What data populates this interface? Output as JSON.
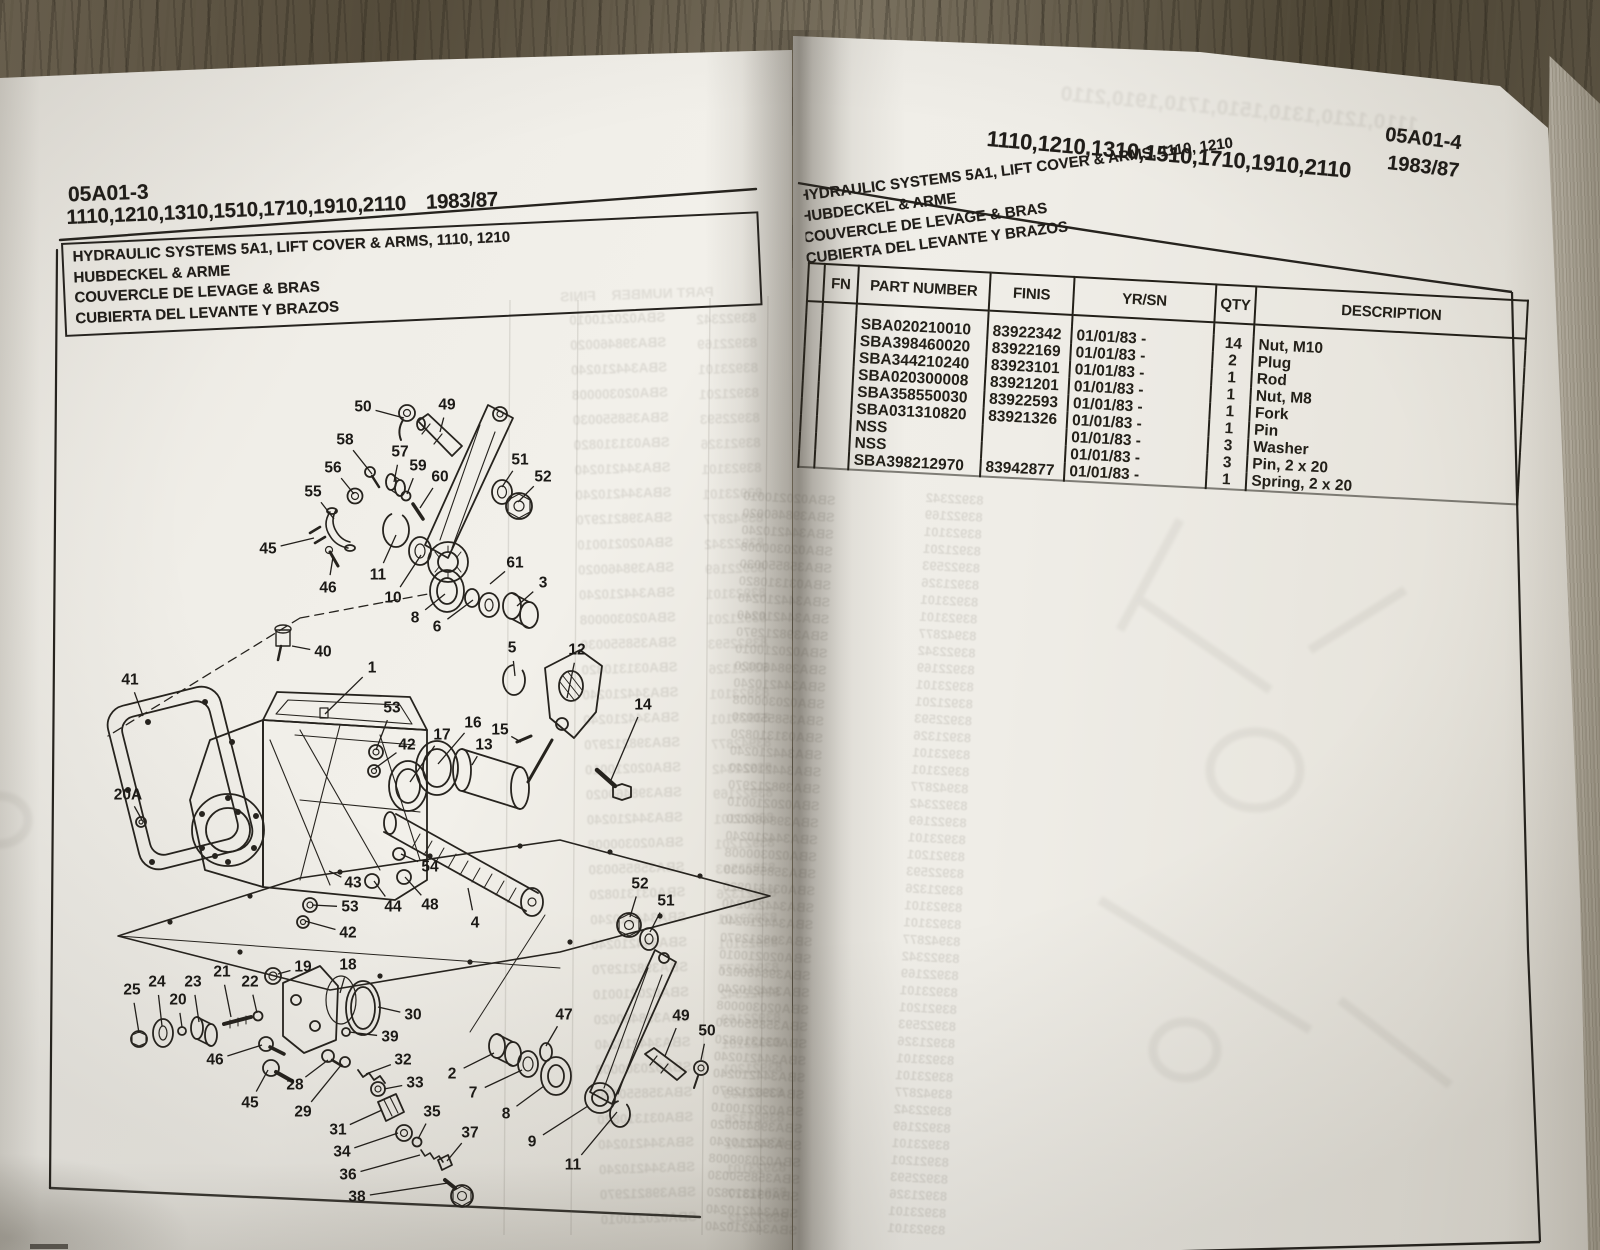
{
  "left_page": {
    "section_code": "05A01-3",
    "models": "1110,1210,1310,1510,1710,1910,2110",
    "years": "1983/87",
    "title_lines": [
      "HYDRAULIC SYSTEMS 5A1, LIFT COVER & ARMS, 1110, 1210",
      "HUBDECKEL & ARME",
      "COUVERCLE DE LEVAGE & BRAS",
      "CUBIERTA DEL LEVANTE Y BRAZOS"
    ],
    "diagram": {
      "callouts": [
        {
          "n": "50",
          "x": 363,
          "y": 407,
          "tx": 404,
          "ty": 418
        },
        {
          "n": "49",
          "x": 447,
          "y": 405,
          "tx": 440,
          "ty": 432
        },
        {
          "n": "58",
          "x": 345,
          "y": 440,
          "tx": 372,
          "ty": 474
        },
        {
          "n": "57",
          "x": 400,
          "y": 452,
          "tx": 394,
          "ty": 482
        },
        {
          "n": "59",
          "x": 418,
          "y": 466,
          "tx": 407,
          "ty": 494
        },
        {
          "n": "60",
          "x": 440,
          "y": 477,
          "tx": 420,
          "ty": 508
        },
        {
          "n": "56",
          "x": 333,
          "y": 468,
          "tx": 354,
          "ty": 494
        },
        {
          "n": "55",
          "x": 313,
          "y": 492,
          "tx": 334,
          "ty": 519
        },
        {
          "n": "45",
          "x": 268,
          "y": 549,
          "tx": 314,
          "ty": 538
        },
        {
          "n": "46",
          "x": 328,
          "y": 588,
          "tx": 333,
          "ty": 557
        },
        {
          "n": "11",
          "x": 378,
          "y": 575,
          "tx": 396,
          "ty": 535
        },
        {
          "n": "10",
          "x": 393,
          "y": 598,
          "tx": 421,
          "ty": 555
        },
        {
          "n": "8",
          "x": 415,
          "y": 618,
          "tx": 445,
          "ty": 594
        },
        {
          "n": "6",
          "x": 437,
          "y": 627,
          "tx": 473,
          "ty": 600
        },
        {
          "n": "61",
          "x": 515,
          "y": 563,
          "tx": 490,
          "ty": 584
        },
        {
          "n": "3",
          "x": 543,
          "y": 583,
          "tx": 517,
          "ty": 606
        },
        {
          "n": "51",
          "x": 520,
          "y": 460,
          "tx": 502,
          "ty": 487
        },
        {
          "n": "52",
          "x": 543,
          "y": 477,
          "tx": 518,
          "ty": 502
        },
        {
          "n": "40",
          "x": 323,
          "y": 652,
          "tx": 292,
          "ty": 646
        },
        {
          "n": "1",
          "x": 372,
          "y": 668,
          "tx": 325,
          "ty": 714
        },
        {
          "n": "41",
          "x": 130,
          "y": 680,
          "tx": 143,
          "ty": 716
        },
        {
          "n": "53",
          "x": 392,
          "y": 708,
          "tx": 376,
          "ty": 750
        },
        {
          "n": "42",
          "x": 407,
          "y": 745,
          "tx": 374,
          "ty": 769
        },
        {
          "n": "17",
          "x": 442,
          "y": 735,
          "tx": 410,
          "ty": 782
        },
        {
          "n": "16",
          "x": 473,
          "y": 723,
          "tx": 438,
          "ty": 764
        },
        {
          "n": "13",
          "x": 484,
          "y": 745,
          "tx": 472,
          "ty": 765
        },
        {
          "n": "15",
          "x": 500,
          "y": 730,
          "tx": 521,
          "ty": 742
        },
        {
          "n": "5",
          "x": 512,
          "y": 648,
          "tx": 515,
          "ty": 676
        },
        {
          "n": "12",
          "x": 577,
          "y": 650,
          "tx": 567,
          "ty": 698
        },
        {
          "n": "14",
          "x": 643,
          "y": 705,
          "tx": 611,
          "ty": 780
        },
        {
          "n": "20A",
          "x": 128,
          "y": 795,
          "tx": 142,
          "ty": 820
        },
        {
          "n": "54",
          "x": 430,
          "y": 867,
          "tx": 401,
          "ty": 854
        },
        {
          "n": "43",
          "x": 353,
          "y": 883,
          "tx": 329,
          "ty": 871
        },
        {
          "n": "44",
          "x": 393,
          "y": 907,
          "tx": 374,
          "ty": 881
        },
        {
          "n": "48",
          "x": 430,
          "y": 905,
          "tx": 405,
          "ty": 877
        },
        {
          "n": "53",
          "x": 350,
          "y": 907,
          "tx": 312,
          "ty": 905
        },
        {
          "n": "42",
          "x": 348,
          "y": 933,
          "tx": 305,
          "ty": 921
        },
        {
          "n": "4",
          "x": 475,
          "y": 923,
          "tx": 468,
          "ty": 888
        },
        {
          "n": "52",
          "x": 640,
          "y": 884,
          "tx": 630,
          "ty": 917
        },
        {
          "n": "51",
          "x": 666,
          "y": 901,
          "tx": 650,
          "ty": 932
        },
        {
          "n": "19",
          "x": 303,
          "y": 967,
          "tx": 278,
          "ty": 974
        },
        {
          "n": "18",
          "x": 348,
          "y": 965,
          "tx": 340,
          "ty": 993
        },
        {
          "n": "30",
          "x": 413,
          "y": 1015,
          "tx": 378,
          "ty": 1007
        },
        {
          "n": "39",
          "x": 390,
          "y": 1037,
          "tx": 349,
          "ty": 1032
        },
        {
          "n": "25",
          "x": 132,
          "y": 990,
          "tx": 139,
          "ty": 1033
        },
        {
          "n": "24",
          "x": 157,
          "y": 982,
          "tx": 162,
          "ty": 1026
        },
        {
          "n": "20",
          "x": 178,
          "y": 1000,
          "tx": 182,
          "ty": 1027
        },
        {
          "n": "23",
          "x": 193,
          "y": 982,
          "tx": 199,
          "ty": 1022
        },
        {
          "n": "21",
          "x": 222,
          "y": 972,
          "tx": 231,
          "ty": 1017
        },
        {
          "n": "22",
          "x": 250,
          "y": 982,
          "tx": 257,
          "ty": 1013
        },
        {
          "n": "46",
          "x": 215,
          "y": 1060,
          "tx": 262,
          "ty": 1045
        },
        {
          "n": "45",
          "x": 250,
          "y": 1103,
          "tx": 268,
          "ty": 1070
        },
        {
          "n": "28",
          "x": 295,
          "y": 1085,
          "tx": 328,
          "ty": 1060
        },
        {
          "n": "29",
          "x": 303,
          "y": 1112,
          "tx": 342,
          "ty": 1064
        },
        {
          "n": "32",
          "x": 403,
          "y": 1060,
          "tx": 366,
          "ty": 1074
        },
        {
          "n": "33",
          "x": 415,
          "y": 1083,
          "tx": 384,
          "ty": 1089
        },
        {
          "n": "31",
          "x": 338,
          "y": 1130,
          "tx": 382,
          "ty": 1110
        },
        {
          "n": "34",
          "x": 342,
          "y": 1152,
          "tx": 398,
          "ty": 1133
        },
        {
          "n": "35",
          "x": 432,
          "y": 1112,
          "tx": 418,
          "ty": 1139
        },
        {
          "n": "36",
          "x": 348,
          "y": 1175,
          "tx": 420,
          "ty": 1155
        },
        {
          "n": "37",
          "x": 470,
          "y": 1133,
          "tx": 447,
          "ty": 1161
        },
        {
          "n": "38",
          "x": 357,
          "y": 1197,
          "tx": 448,
          "ty": 1183
        },
        {
          "n": "2",
          "x": 452,
          "y": 1074,
          "tx": 494,
          "ty": 1053
        },
        {
          "n": "7",
          "x": 473,
          "y": 1093,
          "tx": 522,
          "ty": 1070
        },
        {
          "n": "8",
          "x": 506,
          "y": 1114,
          "tx": 544,
          "ty": 1086
        },
        {
          "n": "9",
          "x": 532,
          "y": 1142,
          "tx": 588,
          "ty": 1106
        },
        {
          "n": "47",
          "x": 564,
          "y": 1015,
          "tx": 546,
          "ty": 1046
        },
        {
          "n": "49",
          "x": 681,
          "y": 1016,
          "tx": 665,
          "ty": 1056
        },
        {
          "n": "50",
          "x": 707,
          "y": 1031,
          "tx": 701,
          "ty": 1060
        },
        {
          "n": "11",
          "x": 573,
          "y": 1165,
          "tx": 617,
          "ty": 1112
        }
      ]
    }
  },
  "right_page": {
    "models": "1110,1210,1310,1510,1710,1910,2110",
    "section_code": "05A01-4",
    "years": "1983/87",
    "title_lines": [
      "HYDRAULIC SYSTEMS 5A1, LIFT COVER & ARMS, 1110, 1210",
      "HUBDECKEL & ARME",
      "COUVERCLE DE LEVAGE & BRAS",
      "CUBIERTA DEL LEVANTE Y BRAZOS"
    ],
    "table": {
      "headers": [
        "",
        "FN",
        "PART NUMBER",
        "FINIS",
        "YR/SN",
        "QTY",
        "DESCRIPTION"
      ],
      "rows": [
        {
          "fn": "",
          "part_number": "SBA020210010",
          "finis": "83922342",
          "yr_sn": "01/01/83 -",
          "qty": "14",
          "description": "Nut, M10"
        },
        {
          "fn": "",
          "part_number": "SBA398460020",
          "finis": "83922169",
          "yr_sn": "01/01/83 -",
          "qty": "2",
          "description": "Plug"
        },
        {
          "fn": "",
          "part_number": "SBA344210240",
          "finis": "83923101",
          "yr_sn": "01/01/83 -",
          "qty": "1",
          "description": "Rod"
        },
        {
          "fn": "",
          "part_number": "SBA020300008",
          "finis": "83921201",
          "yr_sn": "01/01/83 -",
          "qty": "1",
          "description": "Nut, M8"
        },
        {
          "fn": "",
          "part_number": "SBA358550030",
          "finis": "83922593",
          "yr_sn": "01/01/83 -",
          "qty": "1",
          "description": "Fork"
        },
        {
          "fn": "",
          "part_number": "SBA031310820",
          "finis": "83921326",
          "yr_sn": "01/01/83 -",
          "qty": "1",
          "description": "Pin"
        },
        {
          "fn": "",
          "part_number": "NSS",
          "finis": "",
          "yr_sn": "01/01/83 -",
          "qty": "3",
          "description": "Washer"
        },
        {
          "fn": "",
          "part_number": "NSS",
          "finis": "",
          "yr_sn": "01/01/83 -",
          "qty": "3",
          "description": "Pin, 2 x 20"
        },
        {
          "fn": "",
          "part_number": "SBA398212970",
          "finis": "83942877",
          "yr_sn": "01/01/83 -",
          "qty": "1",
          "description": "Spring, 2 x 20"
        }
      ]
    }
  }
}
